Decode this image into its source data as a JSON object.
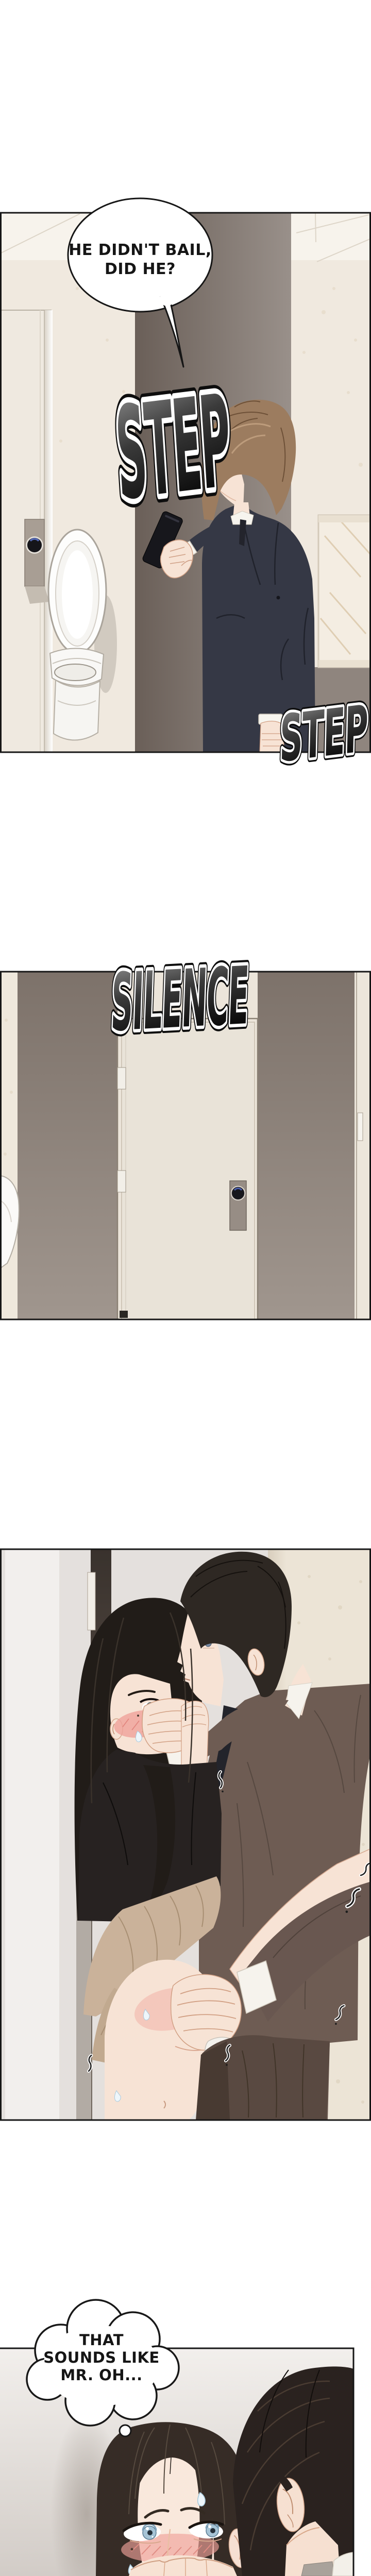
{
  "panel1": {
    "speech_bubble": {
      "line1": "HE DIDN'T BAIL,",
      "line2": "DID HE?"
    },
    "sfx_step_upper": "STEP",
    "sfx_step_lower": "STEP"
  },
  "panel2": {
    "sfx_silence": "SILENCE"
  },
  "panel4": {
    "thought_bubble": {
      "line1": "THAT",
      "line2": "SOUNDS LIKE",
      "line3": "MR. OH..."
    }
  },
  "colors": {
    "border_color": "#161616",
    "sfx_fill_top": "#9a9a9a",
    "sfx_fill_bottom": "#060606",
    "sfx_outline": "#ffffff",
    "p1_wall": "#f0e9df",
    "p1_doorway_dark": "#6a5f58",
    "p1_doorway_light": "#99908a",
    "p1_suit": "#353845",
    "p1_hair": "#9c7c5f",
    "p2_wall_top": "#7d726a",
    "p2_wall_bottom": "#a0968e",
    "p2_door": "#e9e3d8",
    "p3_grey_wall": "#e4e0dd",
    "p3_marble": "#ece4d6",
    "p3_suit": "#6e5c53",
    "p3_trousers": "#594941",
    "p3_skirt": "#cab29a",
    "p3_blouse": "#272221",
    "p3_her_hair": "#211c18",
    "p3_his_hair": "#2e2823",
    "p4_bg_top": "#f2efec",
    "p4_bg_bottom": "#d2ccc7",
    "p4_her_hair": "#362c26",
    "p4_his_hair": "#2a221f",
    "skin": "#f7e3d5",
    "blush": "#efa19a",
    "iris_blue": "#a6c4d6"
  }
}
